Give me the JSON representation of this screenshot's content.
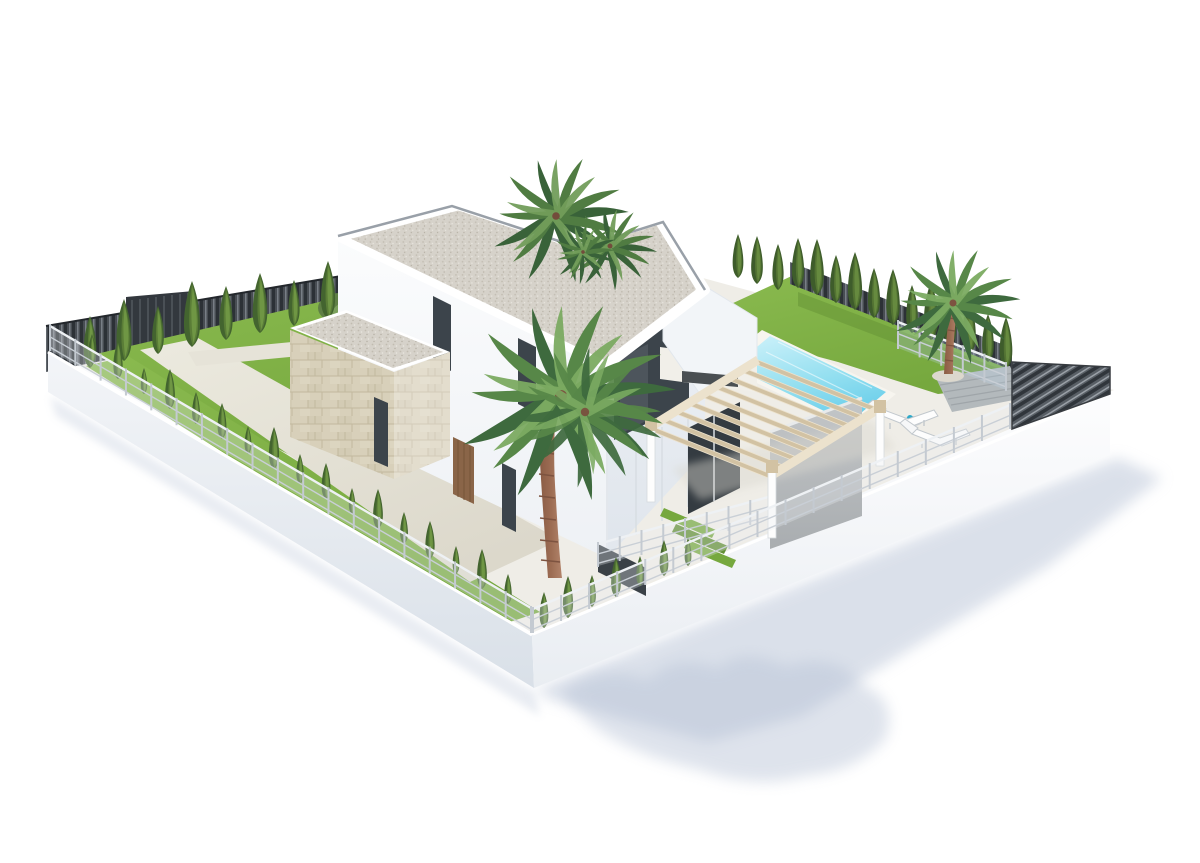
{
  "meta": {
    "type": "3d-architectural-render",
    "subject": "Modern two-story white villa with private pool, pergola and landscaped garden",
    "view": "aerial isometric, white studio background"
  },
  "canvas": {
    "width": 1200,
    "height": 863,
    "background": "#ffffff"
  },
  "palette": {
    "bg": "#ffffff",
    "shadow": "#b7c2d6",
    "wall_light": "#f7f9fb",
    "wall_mid": "#eef1f5",
    "wall_shade": "#e2e7ee",
    "wall_low": "#d9e0e8",
    "roof_gravel": "#d6d2ca",
    "coping_gray": "#99a0a8",
    "stone": "#d8d0ba",
    "stone_line": "#c2b89e",
    "lawn": "#76a83e",
    "lawn_light": "#8aba4f",
    "lawn_dark": "#618f33",
    "cypress_dark": "#43642f",
    "cypress_mid": "#5d8039",
    "cypress_light": "#749c47",
    "palm_dark": "#3e6a3e",
    "palm_mid": "#578748",
    "palm_light": "#7cab62",
    "trunk": "#9c6c53",
    "trunk_dark": "#7d5340",
    "pool_deep": "#67cdea",
    "pool_light": "#c9f0f9",
    "coping_white": "#f7f5ef",
    "path": "#e6e3d8",
    "plot_base": "#efede7",
    "pergola_wood": "#d2c2a3",
    "pergola_light": "#ece2cd",
    "gray_wall": "#b6b9bb",
    "dark_fence": "#484d53",
    "dark_fence_deep": "#2c3136",
    "dark_fence_hi": "#858b92",
    "glass": "#3c444b",
    "door_wood": "#8a6548",
    "deck_gray": "#b3b9bc"
  },
  "scene": {
    "objects": [
      {
        "name": "villa",
        "note": "two-story white house, flat gravel roof with notch where palms grow"
      },
      {
        "name": "stone-garage",
        "note": "single-story stone-clad wing on left"
      },
      {
        "name": "pool",
        "note": "rectangular turquoise pool on right terrace"
      },
      {
        "name": "pergola",
        "note": "light wooden slatted pergola over porch"
      },
      {
        "name": "sun-loungers",
        "note": "two white loungers with small table by pool"
      },
      {
        "name": "driveway",
        "note": "pale concrete drive from slatted gate"
      },
      {
        "name": "perimeter",
        "note": "white retaining walls, white mesh fences, dark slatted privacy fences"
      },
      {
        "name": "planting",
        "note": "cypress rows, clipped hedge, olive bush, three palm groups"
      },
      {
        "name": "cast-shadow",
        "note": "soft blue-gray shadow to lower right"
      }
    ],
    "tree_rows": [
      {
        "group": "row-nw",
        "trees": [
          [
            90,
            368,
            52
          ],
          [
            124,
            361,
            62
          ],
          [
            158,
            354,
            48
          ],
          [
            192,
            347,
            66
          ],
          [
            226,
            340,
            54
          ],
          [
            260,
            333,
            60
          ],
          [
            294,
            326,
            46
          ],
          [
            328,
            319,
            58
          ],
          [
            362,
            312,
            50
          ],
          [
            396,
            305,
            56
          ],
          [
            424,
            298,
            44
          ]
        ]
      },
      {
        "group": "hedge-ne",
        "trees": [
          [
            738,
            278,
            44
          ],
          [
            757,
            284,
            48
          ],
          [
            778,
            290,
            46
          ],
          [
            798,
            288,
            50
          ],
          [
            817,
            295,
            56
          ],
          [
            836,
            303,
            48
          ],
          [
            855,
            310,
            58
          ],
          [
            874,
            318,
            50
          ],
          [
            893,
            325,
            56
          ],
          [
            912,
            333,
            48
          ],
          [
            931,
            340,
            58
          ],
          [
            950,
            347,
            50
          ],
          [
            969,
            355,
            56
          ],
          [
            988,
            362,
            48
          ],
          [
            1006,
            369,
            52
          ]
        ]
      },
      {
        "group": "row-sw",
        "trees": [
          [
            92,
            364,
            30
          ],
          [
            118,
            379,
            38
          ],
          [
            144,
            394,
            26
          ],
          [
            170,
            409,
            40
          ],
          [
            196,
            424,
            32
          ],
          [
            222,
            439,
            36
          ],
          [
            248,
            454,
            28
          ],
          [
            274,
            469,
            42
          ],
          [
            300,
            484,
            30
          ],
          [
            326,
            499,
            36
          ],
          [
            352,
            514,
            26
          ],
          [
            378,
            529,
            40
          ],
          [
            404,
            544,
            32
          ],
          [
            430,
            559,
            38
          ],
          [
            456,
            574,
            28
          ],
          [
            482,
            589,
            40
          ],
          [
            508,
            604,
            30
          ]
        ]
      },
      {
        "group": "row-corner",
        "trees": [
          [
            544,
            628,
            36
          ],
          [
            568,
            618,
            42
          ],
          [
            592,
            607,
            32
          ],
          [
            616,
            597,
            40
          ],
          [
            640,
            586,
            30
          ],
          [
            664,
            576,
            36
          ],
          [
            688,
            566,
            28
          ]
        ]
      }
    ],
    "fences": [
      {
        "group": "fence-sw",
        "x1": 50,
        "y1": 350,
        "x2": 531,
        "y2": 632,
        "h": 24,
        "posts": 20,
        "style": "mesh"
      },
      {
        "group": "fence-se",
        "x1": 533,
        "y1": 632,
        "x2": 1010,
        "y2": 428,
        "h": 23,
        "posts": 18,
        "style": "mesh"
      },
      {
        "group": "rail-pool",
        "x1": 898,
        "y1": 348,
        "x2": 1006,
        "y2": 390,
        "h": 26,
        "posts": 6,
        "style": "glass"
      },
      {
        "group": "rail-patio",
        "x1": 598,
        "y1": 566,
        "x2": 772,
        "y2": 518,
        "h": 22,
        "posts": 9,
        "style": "mesh"
      }
    ],
    "pergola": {
      "sx": 758,
      "sy": 360,
      "stepx": -13.5,
      "stepy": 8.2,
      "dx": 120,
      "dy": 48,
      "n": 9,
      "w": 5
    },
    "loungers": [
      {
        "x": 884,
        "y": 407
      },
      {
        "x": 916,
        "y": 426
      }
    ]
  }
}
